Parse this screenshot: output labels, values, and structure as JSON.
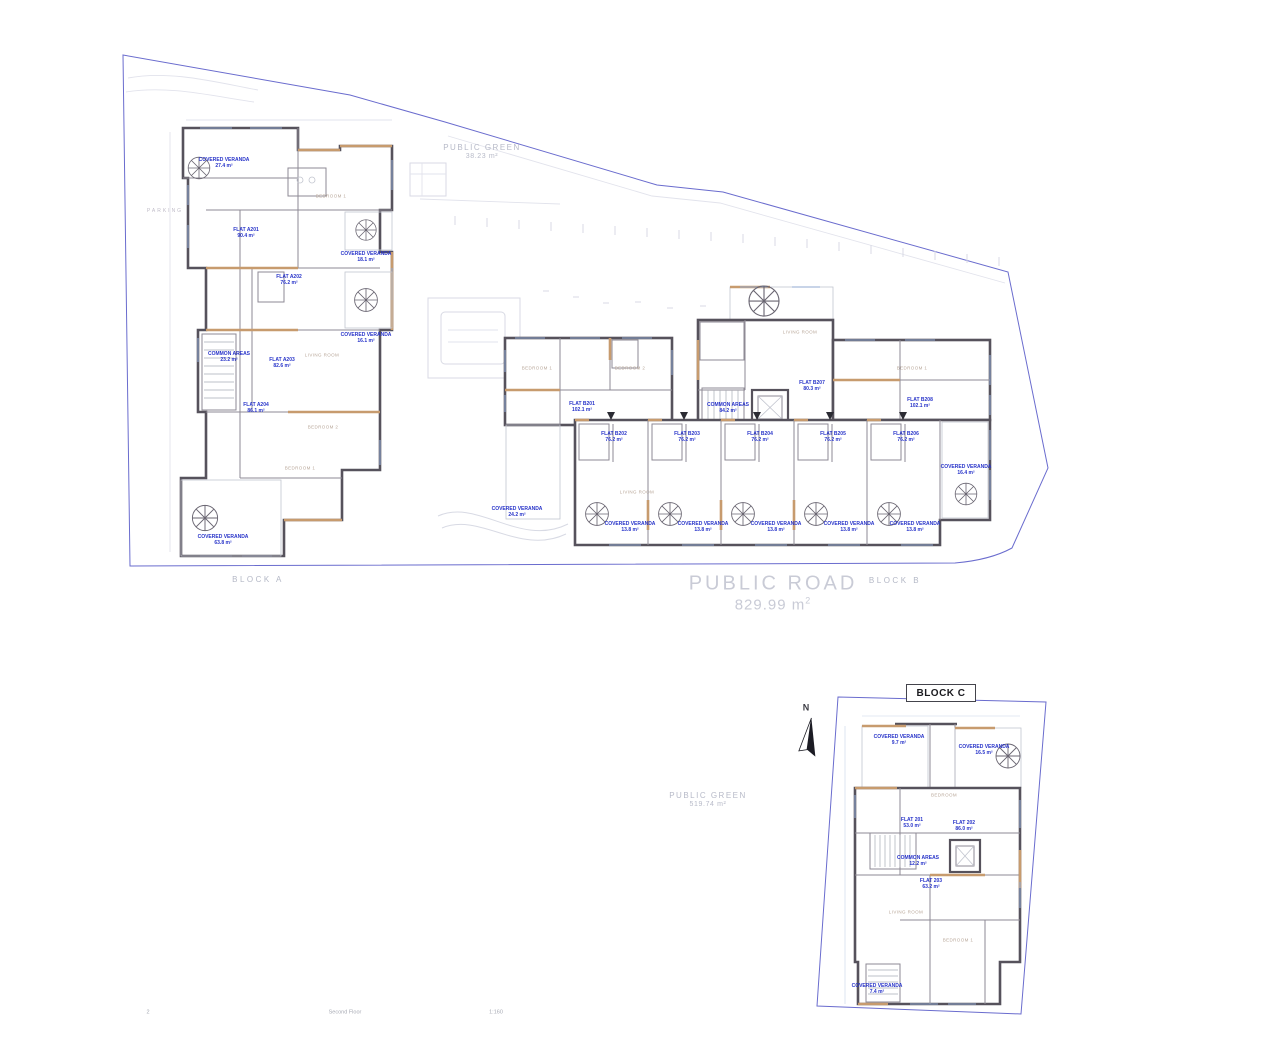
{
  "drawing": {
    "footer": {
      "sheet_number": "2",
      "sheet_title": "Second Floor",
      "scale": "1:160"
    },
    "site": {
      "public_green_top": {
        "name": "PUBLIC GREEN",
        "area": "38.23 m²"
      },
      "public_road": {
        "name": "PUBLIC ROAD",
        "area": "829.99 m",
        "area_sup": "2"
      },
      "public_green_bottom": {
        "name": "PUBLIC GREEN",
        "area": "519.74 m²"
      },
      "parking": "PARKING",
      "north": "N"
    },
    "blocks": {
      "a": {
        "label": "BLOCK A",
        "flats": [
          {
            "name": "FLAT A201",
            "area": "90.4 m²"
          },
          {
            "name": "FLAT A202",
            "area": "76.2 m²"
          },
          {
            "name": "FLAT A203",
            "area": "82.6 m²"
          },
          {
            "name": "FLAT A204",
            "area": "86.1 m²"
          }
        ],
        "common": {
          "name": "COMMON AREAS",
          "area": "23.2 m²"
        },
        "verandas": [
          {
            "name": "COVERED VERANDA",
            "area": "27.4 m²"
          },
          {
            "name": "COVERED VERANDA",
            "area": "18.1 m²"
          },
          {
            "name": "COVERED VERANDA",
            "area": "16.1 m²"
          },
          {
            "name": "COVERED VERANDA",
            "area": "63.8 m²"
          }
        ],
        "rooms": [
          "BEDROOM 1",
          "LIVING ROOM",
          "BEDROOM 2",
          "BEDROOM 1"
        ]
      },
      "b": {
        "label": "BLOCK B",
        "flats": [
          {
            "name": "FLAT B201",
            "area": "102.1 m²"
          },
          {
            "name": "FLAT B202",
            "area": "76.2 m²"
          },
          {
            "name": "FLAT B203",
            "area": "76.2 m²"
          },
          {
            "name": "FLAT B204",
            "area": "76.2 m²"
          },
          {
            "name": "FLAT B205",
            "area": "76.2 m²"
          },
          {
            "name": "FLAT B206",
            "area": "76.2 m²"
          },
          {
            "name": "FLAT B207",
            "area": "80.3 m²"
          },
          {
            "name": "FLAT B208",
            "area": "102.1 m²"
          }
        ],
        "common": {
          "name": "COMMON AREAS",
          "area": "84.2 m²"
        },
        "verandas": [
          {
            "name": "COVERED VERANDA",
            "area": "24.2 m²"
          },
          {
            "name": "COVERED VERANDA",
            "area": "13.8 m²"
          },
          {
            "name": "COVERED VERANDA",
            "area": "13.8 m²"
          },
          {
            "name": "COVERED VERANDA",
            "area": "13.8 m²"
          },
          {
            "name": "COVERED VERANDA",
            "area": "13.8 m²"
          },
          {
            "name": "COVERED VERANDA",
            "area": "13.8 m²"
          },
          {
            "name": "COVERED VERANDA",
            "area": "16.4 m²"
          }
        ],
        "rooms": [
          "BEDROOM 1",
          "BEDROOM 2",
          "LIVING ROOM",
          "BEDROOM 1",
          "LIVING ROOM"
        ]
      },
      "c": {
        "label": "BLOCK C",
        "flats": [
          {
            "name": "FLAT 201",
            "area": "53.0 m²"
          },
          {
            "name": "FLAT 202",
            "area": "86.0 m²"
          },
          {
            "name": "FLAT 203",
            "area": "63.2 m²"
          }
        ],
        "common": {
          "name": "COMMON AREAS",
          "area": "12.2 m²"
        },
        "verandas": [
          {
            "name": "COVERED VERANDA",
            "area": "9.7 m²"
          },
          {
            "name": "COVERED VERANDA",
            "area": "16.5 m²"
          },
          {
            "name": "COVERED VERANDA",
            "area": "7.4 m²"
          }
        ],
        "rooms": [
          "BEDROOM",
          "LIVING ROOM",
          "BEDROOM 1"
        ]
      }
    },
    "colors": {
      "boundary": "#6a6cce",
      "walls": "#56525c",
      "accent_tan": "#c79b6e",
      "annotation_blue": "#2733c9",
      "muted_gray": "#b7bac8"
    }
  }
}
